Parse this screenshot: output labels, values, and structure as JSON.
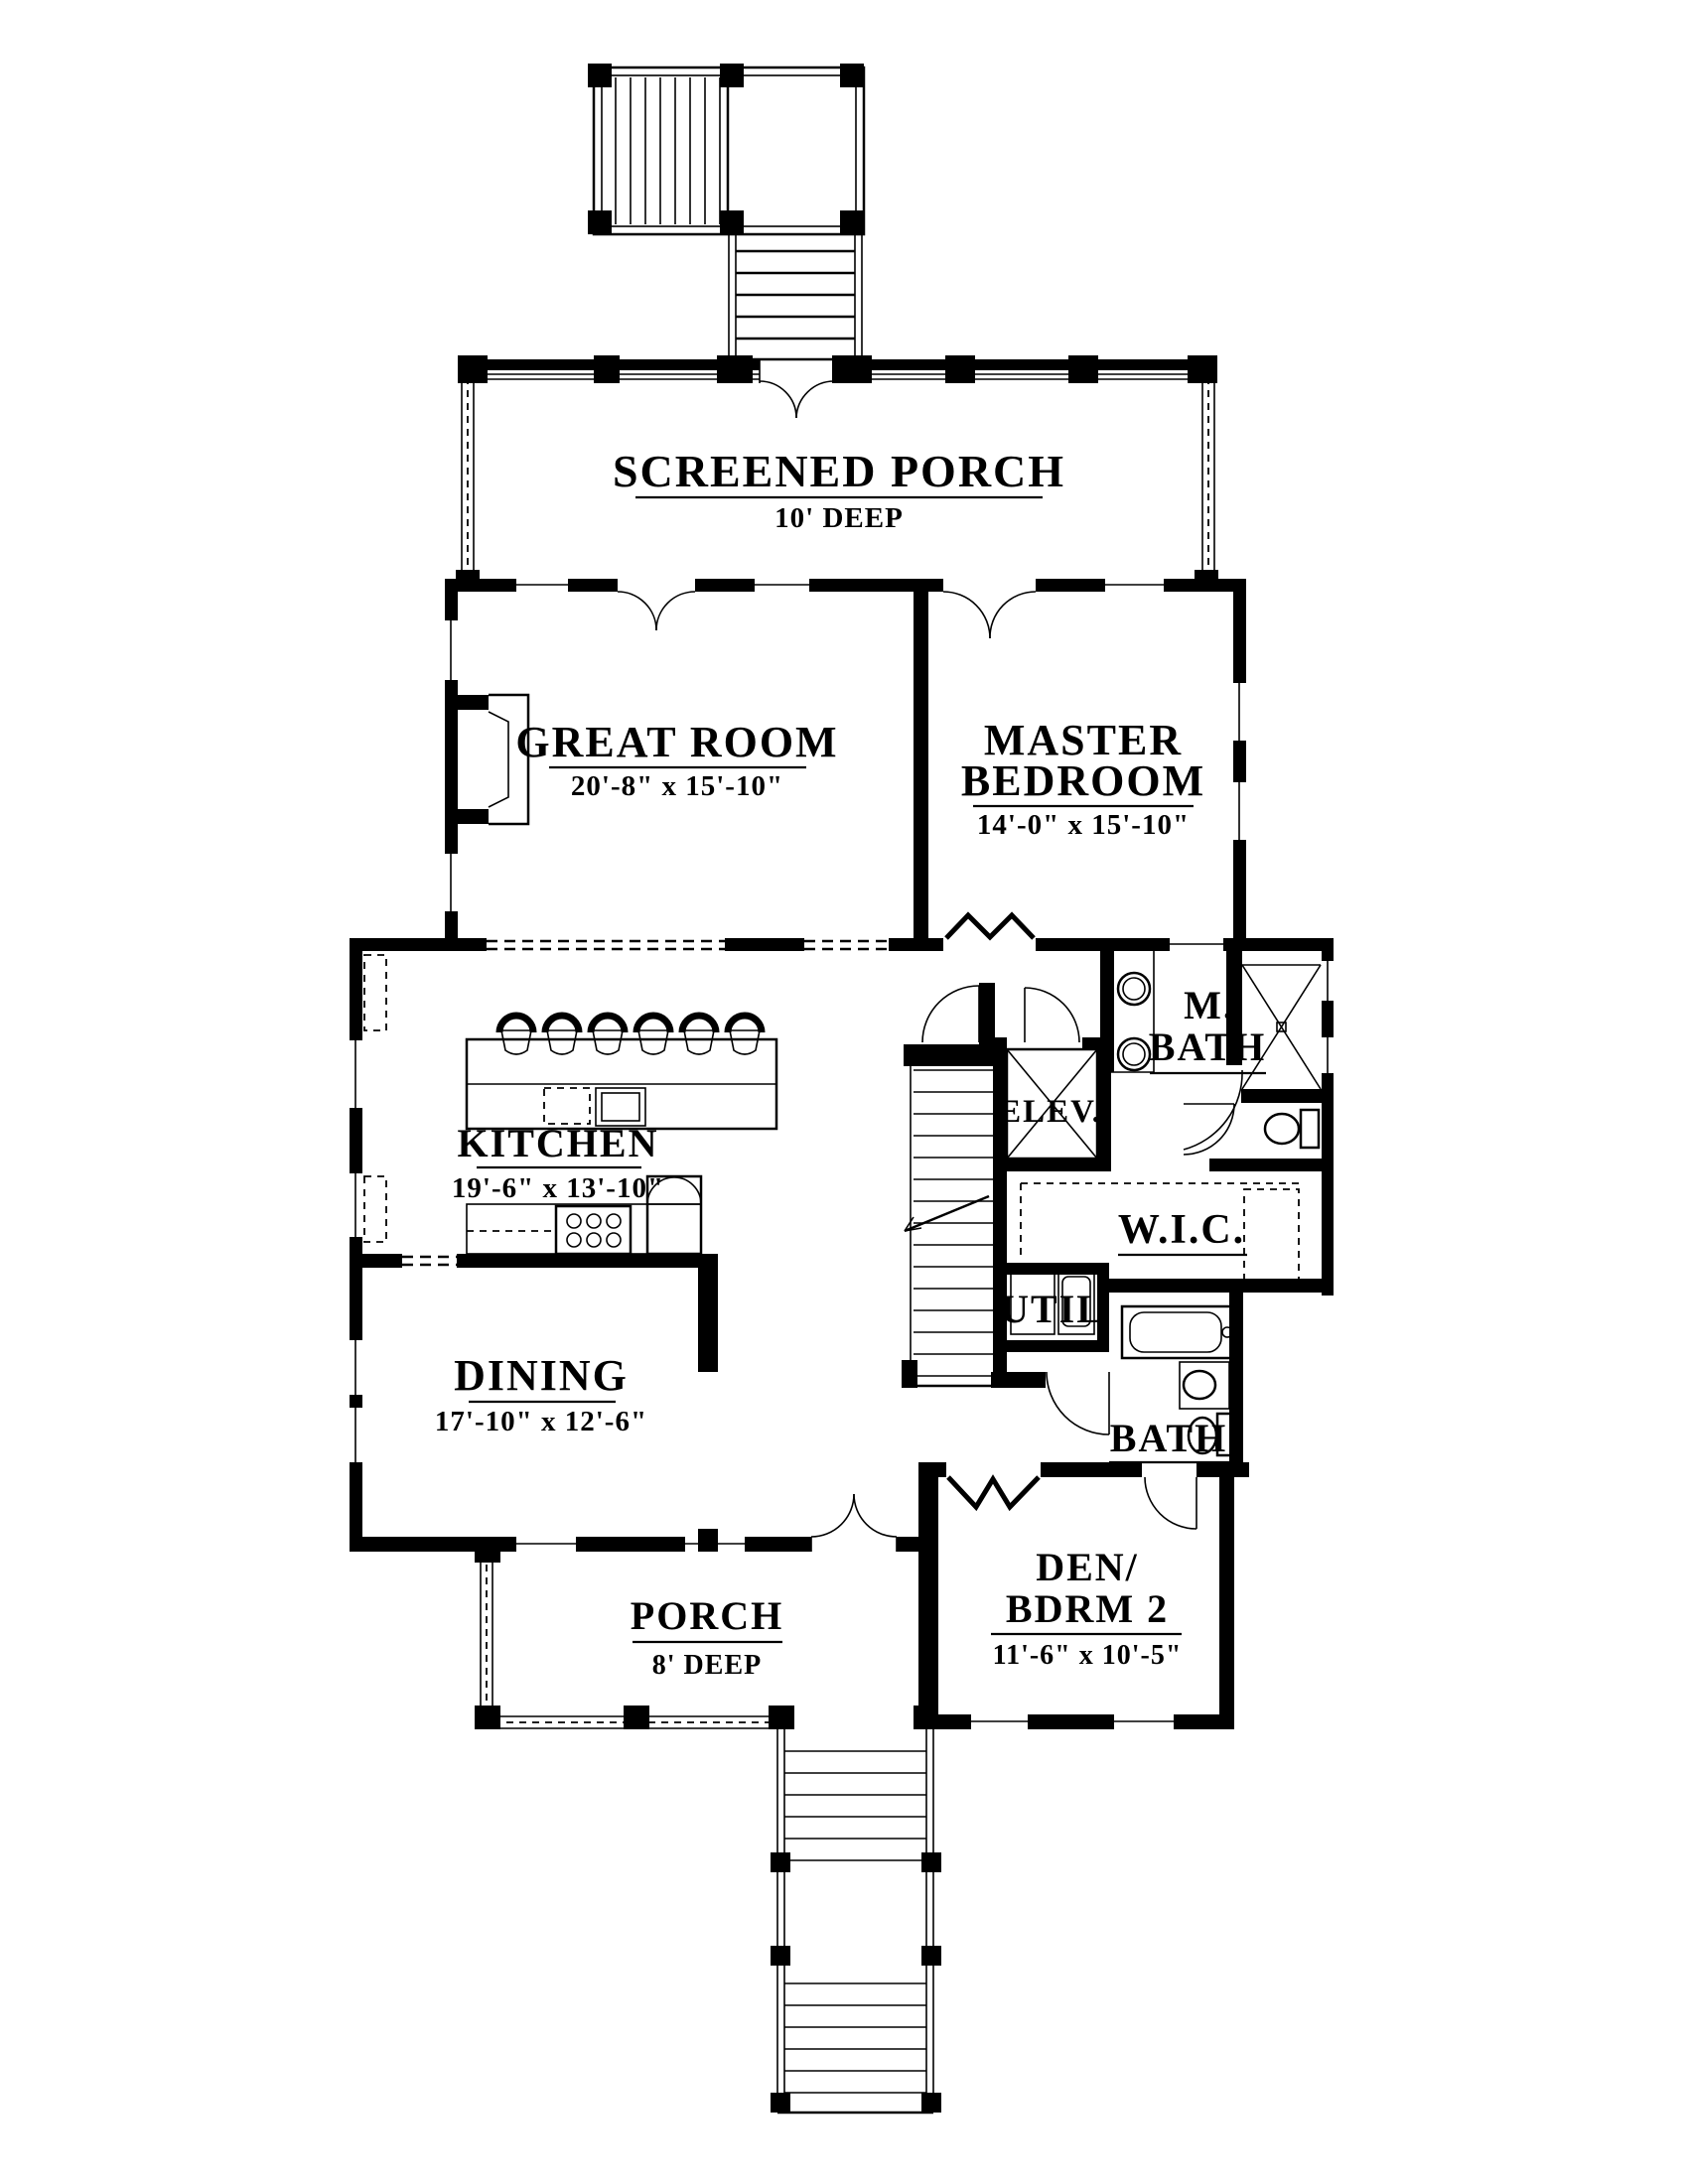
{
  "plan": {
    "background": "#ffffff",
    "line_color": "#000000",
    "rooms": {
      "screened_porch": {
        "name": "SCREENED PORCH",
        "dims": "10' DEEP"
      },
      "great_room": {
        "name": "GREAT ROOM",
        "dims": "20'-8\" x 15'-10\""
      },
      "master_bedroom": {
        "line1": "MASTER",
        "line2": "BEDROOM",
        "dims": "14'-0\" x 15'-10\""
      },
      "kitchen": {
        "name": "KITCHEN",
        "dims": "19'-6\" x 13'-10\""
      },
      "dining": {
        "name": "DINING",
        "dims": "17'-10\" x 12'-6\""
      },
      "elevator": {
        "name": "ELEV."
      },
      "master_bath": {
        "line1": "M.",
        "line2": "BATH"
      },
      "walk_in_closet": {
        "name": "W.I.C."
      },
      "utility": {
        "name": "UTIL"
      },
      "bath": {
        "name": "BATH"
      },
      "den_bedroom2": {
        "line1": "DEN/",
        "line2": "BDRM 2",
        "dims": "11'-6\" x 10'-5\""
      },
      "porch": {
        "name": "PORCH",
        "dims": "8' DEEP"
      }
    }
  }
}
